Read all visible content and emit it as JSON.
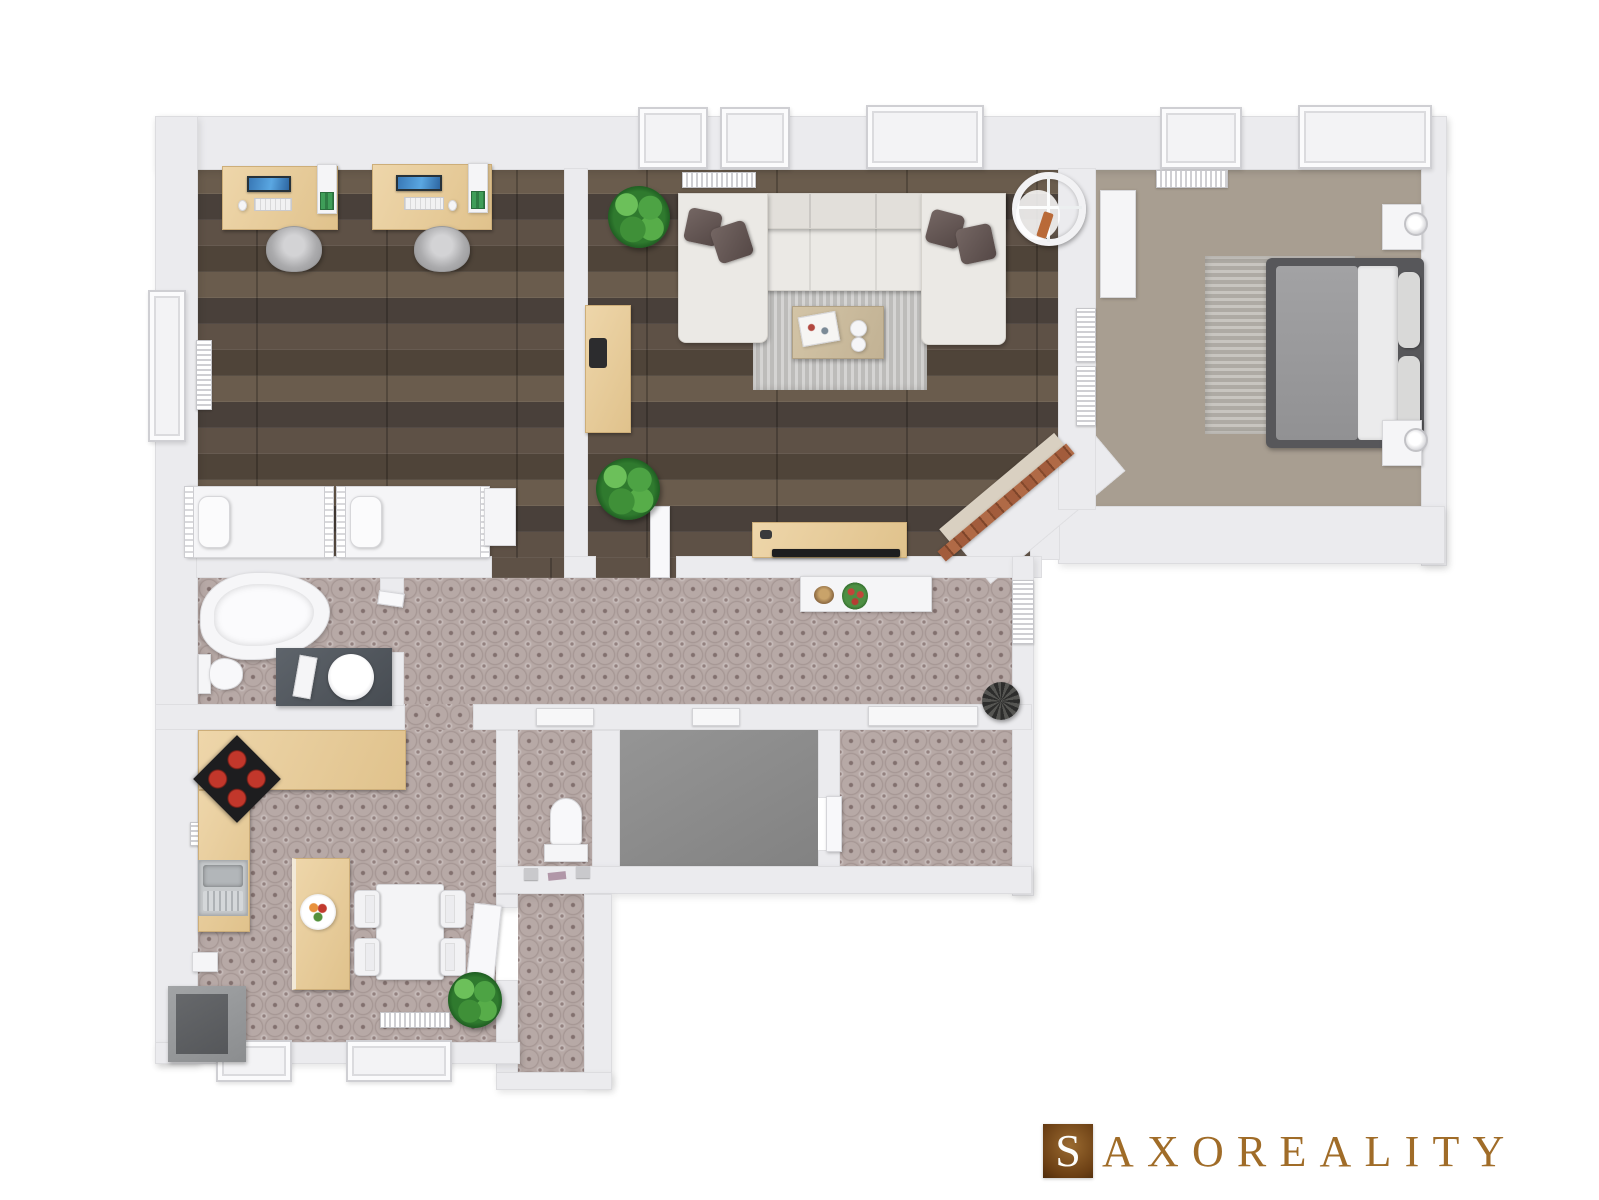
{
  "logo": {
    "initial": "S",
    "rest": "AXOREALITY",
    "brand_color": "#a06c28",
    "square_gradient": [
      "#9a6a30",
      "#4e2c0c"
    ]
  },
  "palette": {
    "background": "#ffffff",
    "wall": "#ebebee",
    "dark_wood_floor": "#544940",
    "light_wood_floor": "#a89e91",
    "ornament_tile_floor": "#b7a9a6",
    "tile_ornament": "#82706e",
    "gray_floor": "#8d8d8d",
    "counter_wood": "#e8d09e",
    "sofa_fabric": "#ebe9e5",
    "pillow": "#675b59",
    "burner_red": "#c2372b",
    "plant_green": "#3f9038",
    "brick": "#a25c3c"
  },
  "scene": {
    "type": "3d-floor-plan-top-view",
    "rooms": [
      {
        "name": "office-kids-room",
        "floor": "dark-wood",
        "furniture": [
          "desk",
          "desk",
          "office-chair",
          "office-chair",
          "single-bed",
          "single-bed",
          "wall-shelf",
          "wall-shelf",
          "window",
          "radiator",
          "cabinet"
        ]
      },
      {
        "name": "living-room",
        "floor": "dark-wood",
        "furniture": [
          "corner-sofa",
          "throw-pillows",
          "rug",
          "coffee-table",
          "tv-stand",
          "tv",
          "sideboard",
          "hanging-chair",
          "corner-fireplace",
          "plant",
          "plant",
          "windows",
          "radiator"
        ]
      },
      {
        "name": "bedroom",
        "floor": "light-wood",
        "furniture": [
          "double-bed",
          "nightstand",
          "nightstand",
          "lamp",
          "lamp",
          "rug",
          "wardrobe",
          "radiator",
          "radiator",
          "windows"
        ]
      },
      {
        "name": "hallway",
        "floor": "ornament-tile",
        "furniture": [
          "console-table",
          "flower-vase",
          "bowl",
          "dark-plant-stand",
          "entrance-door"
        ]
      },
      {
        "name": "bathroom",
        "floor": "ornament-tile",
        "furniture": [
          "bathtub",
          "toilet",
          "vanity-with-sink",
          "tray"
        ]
      },
      {
        "name": "kitchen-dining",
        "floor": "ornament-tile",
        "furniture": [
          "l-shaped-counter",
          "cooktop",
          "double-sink",
          "fridge",
          "island",
          "fruit-bowl",
          "dining-table",
          "chair",
          "chair",
          "chair",
          "chair",
          "plant",
          "radiator",
          "windows"
        ]
      },
      {
        "name": "wc",
        "floor": "ornament-tile",
        "furniture": [
          "toilet",
          "shelf-items"
        ]
      },
      {
        "name": "storage-room",
        "floor": "gray-concrete",
        "furniture": []
      },
      {
        "name": "closet-room",
        "floor": "ornament-tile",
        "furniture": []
      },
      {
        "name": "south-corridor",
        "floor": "ornament-tile",
        "furniture": []
      }
    ]
  }
}
